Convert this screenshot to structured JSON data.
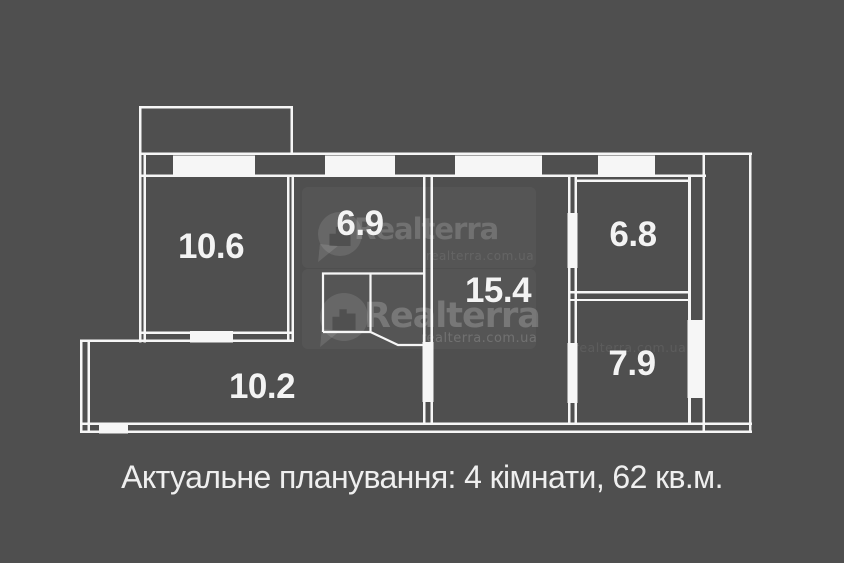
{
  "caption": "Актуальне планування: 4 кімнати, 62 кв.м.",
  "rooms": {
    "bedroom_left": "10.6",
    "kitchen": "6.9",
    "living_room": "15.4",
    "room_top_right": "6.8",
    "room_bottom_right": "7.9",
    "hallway": "10.2"
  },
  "watermark": {
    "brand": "Realterra",
    "domain": "realterra.com.ua"
  },
  "colors": {
    "background": "#4f4f4f",
    "walls": "#f6f6f6",
    "label_text": "#f3f3f3"
  }
}
